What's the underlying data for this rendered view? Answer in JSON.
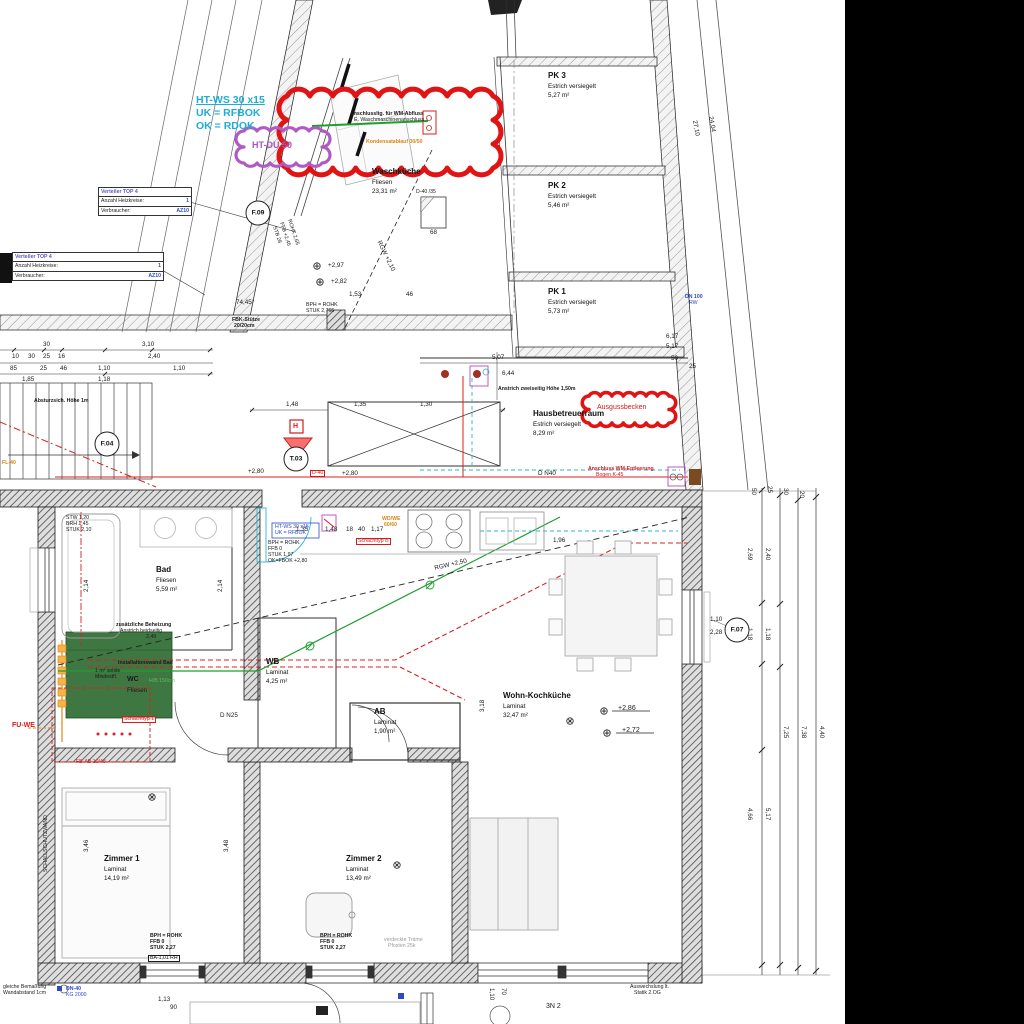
{
  "title": "Installationsplan Erdgeschoss (Ausschnitt)",
  "colors": {
    "annotation_red": "#e01414",
    "cloud_purple": "#b05ac4",
    "pipe_cyan": "#2ab5d8",
    "pipe_green": "#1f9e30",
    "pipe_red": "#d82020",
    "manifold_orange": "#e08a18",
    "label_blue": "#2d49c8",
    "wc_green": "#2f6b33",
    "background": "#ffffff",
    "void_right": "#000000"
  },
  "rooms": [
    {
      "name": "PK 3",
      "floor": "Estrich versiegelt",
      "area": "5,27 m²",
      "x": 548,
      "y": 70
    },
    {
      "name": "PK 2",
      "floor": "Estrich versiegelt",
      "area": "5,46 m²",
      "x": 548,
      "y": 180
    },
    {
      "name": "PK 1",
      "floor": "Estrich versiegelt",
      "area": "5,73 m²",
      "x": 548,
      "y": 286
    },
    {
      "name": "Waschküche",
      "floor": "Fliesen",
      "area": "23,31 m²",
      "x": 372,
      "y": 166
    },
    {
      "name": "Hausbetreuerraum",
      "floor": "Estrich versiegelt",
      "area": "8,29 m²",
      "x": 533,
      "y": 408
    },
    {
      "name": "Bad",
      "floor": "Fliesen",
      "area": "5,59 m²",
      "x": 156,
      "y": 564
    },
    {
      "name": "WB",
      "floor": "Laminat",
      "area": "4,25 m²",
      "x": 266,
      "y": 656
    },
    {
      "name": "AB",
      "floor": "Laminat",
      "area": "1,90 m²",
      "x": 374,
      "y": 706
    },
    {
      "name": "Wohn-Kochküche",
      "floor": "Laminat",
      "area": "32,47 m²",
      "x": 503,
      "y": 690
    },
    {
      "name": "Zimmer 1",
      "floor": "Laminat",
      "area": "14,19 m²",
      "x": 104,
      "y": 853
    },
    {
      "name": "Zimmer 2",
      "floor": "Laminat",
      "area": "13,49 m²",
      "x": 346,
      "y": 853
    }
  ],
  "tags": [
    {
      "t": "F.09",
      "x": 258,
      "y": 213
    },
    {
      "t": "F.04",
      "x": 107,
      "y": 444
    },
    {
      "t": "T.03",
      "x": 296,
      "y": 459
    },
    {
      "t": "F.07",
      "x": 737,
      "y": 630
    }
  ],
  "clouds": [
    {
      "name": "revision-cloud-wm",
      "x": 287,
      "y": 96,
      "w": 206,
      "h": 72,
      "r": 13,
      "color": "#e01414",
      "sw": 5
    },
    {
      "name": "revision-cloud-htdu",
      "x": 244,
      "y": 131,
      "w": 78,
      "h": 32,
      "r": 8,
      "color": "#b05ac4",
      "sw": 3.2
    },
    {
      "name": "revision-cloud-ausgussbecken",
      "x": 589,
      "y": 396,
      "w": 80,
      "h": 27,
      "r": 6.5,
      "color": "#e01414",
      "sw": 3.6
    }
  ],
  "symbols": [
    {
      "ch": "⊗",
      "x": 570,
      "y": 722,
      "n": "light-outlet-symbol"
    },
    {
      "ch": "⊗",
      "x": 397,
      "y": 866,
      "n": "light-outlet-symbol"
    },
    {
      "ch": "⊗",
      "x": 152,
      "y": 798,
      "n": "light-outlet-symbol"
    },
    {
      "ch": "⊕",
      "x": 604,
      "y": 712,
      "n": "level-point-symbol"
    },
    {
      "ch": "⊕",
      "x": 607,
      "y": 734,
      "n": "level-point-symbol"
    },
    {
      "ch": "⊕",
      "x": 317,
      "y": 267,
      "n": "level-point-symbol"
    },
    {
      "ch": "⊕",
      "x": 320,
      "y": 283,
      "n": "level-point-symbol"
    }
  ],
  "verteiler": {
    "title": "Verteiler TOP 4",
    "rows": [
      {
        "label": "Anzahl Heizkreise:",
        "value": "1"
      },
      {
        "label": "Verbraucher:",
        "value": "AZ10"
      }
    ]
  },
  "verteiler_boxes": [
    {
      "x": 98,
      "y": 187,
      "w": 92
    },
    {
      "x": 12,
      "y": 252,
      "w": 150
    }
  ],
  "labels": [
    {
      "t": "HT-WS 30 x15",
      "x": 196,
      "y": 95,
      "c": "cyan u"
    },
    {
      "t": "UK = RFBOK",
      "x": 196,
      "y": 108,
      "c": "cyan"
    },
    {
      "t": "OK = RDOK",
      "x": 196,
      "y": 121,
      "c": "cyan"
    },
    {
      "t": "HT-DU 50",
      "x": 252,
      "y": 141,
      "c": "purple"
    },
    {
      "t": "Anschlussltg. für WM-Abfluss",
      "x": 350,
      "y": 112,
      "c": "micro b"
    },
    {
      "t": "E. Waschmaschinenanschluss",
      "x": 354,
      "y": 118,
      "c": "micro"
    },
    {
      "t": "Kondensatablauf 30/50",
      "x": 366,
      "y": 140,
      "c": "micro orange b"
    },
    {
      "t": "D-40 /35",
      "x": 416,
      "y": 190,
      "c": "micro"
    },
    {
      "t": "68",
      "x": 430,
      "y": 230,
      "c": "d"
    },
    {
      "t": "74,45°",
      "x": 236,
      "y": 300,
      "c": "d"
    },
    {
      "t": "FFB +2,45",
      "x": 283,
      "y": 222,
      "c": "micro rot72"
    },
    {
      "t": "ROHK 2,65",
      "x": 291,
      "y": 219,
      "c": "micro rot72"
    },
    {
      "t": "STB 28",
      "x": 276,
      "y": 226,
      "c": "micro rot72"
    },
    {
      "t": "+2,97",
      "x": 328,
      "y": 263,
      "c": "d"
    },
    {
      "t": "+2,82",
      "x": 331,
      "y": 279,
      "c": "d"
    },
    {
      "t": "1,53",
      "x": 349,
      "y": 292,
      "c": "d"
    },
    {
      "t": "46",
      "x": 406,
      "y": 292,
      "c": "d"
    },
    {
      "t": "BPH = ROHK",
      "x": 306,
      "y": 303,
      "c": "micro"
    },
    {
      "t": "STUK 2,765",
      "x": 306,
      "y": 309,
      "c": "micro"
    },
    {
      "t": "RGW +2,10",
      "x": 381,
      "y": 240,
      "c": "d rot64"
    },
    {
      "t": "27,10",
      "x": 697,
      "y": 120,
      "c": "d rot80"
    },
    {
      "t": "24,04",
      "x": 713,
      "y": 116,
      "c": "d rot80"
    },
    {
      "t": "DN 100",
      "x": 685,
      "y": 295,
      "c": "micro blue b"
    },
    {
      "t": "RW",
      "x": 689,
      "y": 301,
      "c": "micro blue"
    },
    {
      "t": "FBK-Stütze",
      "x": 232,
      "y": 318,
      "c": "micro b"
    },
    {
      "t": "20/20cm",
      "x": 234,
      "y": 324,
      "c": "micro b"
    },
    {
      "t": "6,17",
      "x": 666,
      "y": 334,
      "c": "d"
    },
    {
      "t": "5,17",
      "x": 666,
      "y": 344,
      "c": "d"
    },
    {
      "t": "30",
      "x": 43,
      "y": 342,
      "c": "d"
    },
    {
      "t": "3,10",
      "x": 142,
      "y": 342,
      "c": "d"
    },
    {
      "t": "10",
      "x": 12,
      "y": 354,
      "c": "d"
    },
    {
      "t": "30",
      "x": 28,
      "y": 354,
      "c": "d"
    },
    {
      "t": "25",
      "x": 43,
      "y": 354,
      "c": "d"
    },
    {
      "t": "16",
      "x": 58,
      "y": 354,
      "c": "d"
    },
    {
      "t": "2,40",
      "x": 148,
      "y": 354,
      "c": "d"
    },
    {
      "t": "85",
      "x": 10,
      "y": 366,
      "c": "d"
    },
    {
      "t": "25",
      "x": 40,
      "y": 366,
      "c": "d"
    },
    {
      "t": "46",
      "x": 60,
      "y": 366,
      "c": "d"
    },
    {
      "t": "1,10",
      "x": 98,
      "y": 366,
      "c": "d"
    },
    {
      "t": "1,10",
      "x": 173,
      "y": 366,
      "c": "d"
    },
    {
      "t": "1,85",
      "x": 22,
      "y": 377,
      "c": "d"
    },
    {
      "t": "1,18",
      "x": 98,
      "y": 377,
      "c": "d"
    },
    {
      "t": "Absturzsich. Höhe 1m",
      "x": 34,
      "y": 399,
      "c": "micro b"
    },
    {
      "t": "FL-40",
      "x": 2,
      "y": 461,
      "c": "micro orange b"
    },
    {
      "t": "1,48",
      "x": 286,
      "y": 402,
      "c": "d"
    },
    {
      "t": "1,35",
      "x": 354,
      "y": 402,
      "c": "d"
    },
    {
      "t": "1,30",
      "x": 420,
      "y": 402,
      "c": "d"
    },
    {
      "t": "H",
      "x": 293,
      "y": 423,
      "c": "s red b"
    },
    {
      "t": "+2,80",
      "x": 248,
      "y": 469,
      "c": "d"
    },
    {
      "t": "+2,80",
      "x": 342,
      "y": 471,
      "c": "d"
    },
    {
      "t": "D-40",
      "x": 310,
      "y": 470,
      "c": "micro red boxed"
    },
    {
      "t": "5,07",
      "x": 492,
      "y": 355,
      "c": "d"
    },
    {
      "t": "6,44",
      "x": 502,
      "y": 371,
      "c": "d"
    },
    {
      "t": "50",
      "x": 671,
      "y": 356,
      "c": "d"
    },
    {
      "t": "25",
      "x": 689,
      "y": 364,
      "c": "d"
    },
    {
      "t": "Anstrich zweiseitig Höhe 1,50m",
      "x": 498,
      "y": 387,
      "c": "micro b"
    },
    {
      "t": "Ausgussbecken",
      "x": 597,
      "y": 404,
      "c": "s red"
    },
    {
      "t": "D N40",
      "x": 538,
      "y": 471,
      "c": "d"
    },
    {
      "t": "Anschluss WM-Entleerung",
      "x": 588,
      "y": 467,
      "c": "micro red b"
    },
    {
      "t": "Bogen K-45",
      "x": 596,
      "y": 473,
      "c": "micro red"
    },
    {
      "t": "STW 1,20",
      "x": 66,
      "y": 516,
      "c": "micro"
    },
    {
      "t": "BRH 1,45",
      "x": 66,
      "y": 522,
      "c": "micro"
    },
    {
      "t": "STUK 2,10",
      "x": 66,
      "y": 528,
      "c": "micro"
    },
    {
      "t": "1,35",
      "x": 296,
      "y": 527,
      "c": "d"
    },
    {
      "t": "1,48",
      "x": 325,
      "y": 527,
      "c": "d"
    },
    {
      "t": "18",
      "x": 346,
      "y": 527,
      "c": "d"
    },
    {
      "t": "40",
      "x": 358,
      "y": 527,
      "c": "d"
    },
    {
      "t": "1,17",
      "x": 371,
      "y": 527,
      "c": "d"
    },
    {
      "t": "1,96",
      "x": 553,
      "y": 538,
      "c": "d"
    },
    {
      "t": "WD/WE",
      "x": 382,
      "y": 517,
      "c": "micro orange b"
    },
    {
      "t": "60/60",
      "x": 384,
      "y": 523,
      "c": "micro orange b"
    },
    {
      "t": "Schachttyp B",
      "x": 356,
      "y": 538,
      "c": "micro red boxed"
    },
    {
      "t": "HT-WS 30 x15",
      "x": 275,
      "y": 525,
      "c": "micro blue"
    },
    {
      "t": "UK = RFBOK",
      "x": 275,
      "y": 531,
      "c": "micro blue"
    },
    {
      "t": "BPH = ROHK",
      "x": 268,
      "y": 541,
      "c": "micro"
    },
    {
      "t": "FFB 0",
      "x": 268,
      "y": 547,
      "c": "micro"
    },
    {
      "t": "STUK 1,97",
      "x": 268,
      "y": 553,
      "c": "micro"
    },
    {
      "t": "OK=FBOK +2,80",
      "x": 268,
      "y": 559,
      "c": "micro"
    },
    {
      "t": "2,14",
      "x": 84,
      "y": 592,
      "c": "d rotm90"
    },
    {
      "t": "2,14",
      "x": 218,
      "y": 592,
      "c": "d rotm90"
    },
    {
      "t": "zusätzliche Beheizung",
      "x": 116,
      "y": 623,
      "c": "micro b"
    },
    {
      "t": "Anstrich beidseitig",
      "x": 120,
      "y": 629,
      "c": "micro"
    },
    {
      "t": "2,49",
      "x": 146,
      "y": 635,
      "c": "micro"
    },
    {
      "t": "Installationswand Bad",
      "x": 118,
      "y": 661,
      "c": "micro b"
    },
    {
      "t": "1 m² solide",
      "x": 95,
      "y": 669,
      "c": "micro"
    },
    {
      "t": "Mindestfl.",
      "x": 95,
      "y": 675,
      "c": "micro"
    },
    {
      "t": "WC",
      "x": 127,
      "y": 676,
      "c": "b"
    },
    {
      "t": "Fliesen",
      "x": 127,
      "y": 688,
      "c": "d"
    },
    {
      "t": "H/B 150cm",
      "x": 149,
      "y": 679,
      "c": "micro green2"
    },
    {
      "t": "D N25",
      "x": 220,
      "y": 713,
      "c": "d"
    },
    {
      "t": "Schachttyp 1",
      "x": 122,
      "y": 716,
      "c": "micro red boxed"
    },
    {
      "t": "FU-WE",
      "x": 12,
      "y": 722,
      "c": "s red b"
    },
    {
      "t": "FB-AB 10/48",
      "x": 76,
      "y": 760,
      "c": "micro red"
    },
    {
      "t": "+2,86",
      "x": 618,
      "y": 705,
      "c": "s"
    },
    {
      "t": "+2,72",
      "x": 622,
      "y": 727,
      "c": "s"
    },
    {
      "t": "1,10",
      "x": 710,
      "y": 617,
      "c": "d"
    },
    {
      "t": "2,28",
      "x": 710,
      "y": 630,
      "c": "d"
    },
    {
      "t": "SCHALLSCHUTZWAND",
      "x": 44,
      "y": 872,
      "c": "micro rotm90"
    },
    {
      "t": "3,46",
      "x": 84,
      "y": 852,
      "c": "d rotm90"
    },
    {
      "t": "3,48",
      "x": 224,
      "y": 852,
      "c": "d rotm90"
    },
    {
      "t": "3,18",
      "x": 480,
      "y": 712,
      "c": "d rotm90"
    },
    {
      "t": "BPH = ROHK",
      "x": 150,
      "y": 934,
      "c": "micro b"
    },
    {
      "t": "FFB 0",
      "x": 150,
      "y": 940,
      "c": "micro b"
    },
    {
      "t": "STUK 2,27",
      "x": 150,
      "y": 946,
      "c": "micro b"
    },
    {
      "t": "BPH = ROHK",
      "x": 320,
      "y": 934,
      "c": "micro b"
    },
    {
      "t": "FFB 0",
      "x": 320,
      "y": 940,
      "c": "micro b"
    },
    {
      "t": "STUK 2,27",
      "x": 320,
      "y": 946,
      "c": "micro b"
    },
    {
      "t": "verdeckte Träme",
      "x": 384,
      "y": 938,
      "c": "micro gray"
    },
    {
      "t": "Pfosten 25k",
      "x": 388,
      "y": 944,
      "c": "micro gray"
    },
    {
      "t": "BA-1,01 RH",
      "x": 148,
      "y": 955,
      "c": "micro boxed"
    },
    {
      "t": "RGW +2,50",
      "x": 434,
      "y": 566,
      "c": "d rotm13"
    },
    {
      "t": "2,69",
      "x": 752,
      "y": 548,
      "c": "d rot90"
    },
    {
      "t": "2,40",
      "x": 770,
      "y": 548,
      "c": "d rot90"
    },
    {
      "t": "1,18",
      "x": 752,
      "y": 628,
      "c": "d rot90"
    },
    {
      "t": "1,18",
      "x": 770,
      "y": 628,
      "c": "d rot90"
    },
    {
      "t": "4,66",
      "x": 752,
      "y": 808,
      "c": "d rot90"
    },
    {
      "t": "5,17",
      "x": 770,
      "y": 808,
      "c": "d rot90"
    },
    {
      "t": "7,25",
      "x": 788,
      "y": 726,
      "c": "d rot90"
    },
    {
      "t": "7,38",
      "x": 806,
      "y": 726,
      "c": "d rot90"
    },
    {
      "t": "4,40",
      "x": 824,
      "y": 726,
      "c": "d rot90"
    },
    {
      "t": "50",
      "x": 756,
      "y": 488,
      "c": "d rot90"
    },
    {
      "t": "25",
      "x": 772,
      "y": 486,
      "c": "d rot90"
    },
    {
      "t": "30",
      "x": 788,
      "y": 488,
      "c": "d rot90"
    },
    {
      "t": "20",
      "x": 804,
      "y": 491,
      "c": "d rot90"
    },
    {
      "t": "gleiche Bemaßung",
      "x": 3,
      "y": 985,
      "c": "micro"
    },
    {
      "t": "Wandabstand 1cm",
      "x": 3,
      "y": 991,
      "c": "micro"
    },
    {
      "t": "DN-40",
      "x": 66,
      "y": 987,
      "c": "micro blue b"
    },
    {
      "t": "KG 2000",
      "x": 66,
      "y": 993,
      "c": "micro blue"
    },
    {
      "t": "1,13",
      "x": 158,
      "y": 997,
      "c": "d"
    },
    {
      "t": "90",
      "x": 170,
      "y": 1005,
      "c": "d"
    },
    {
      "t": "1,10",
      "x": 494,
      "y": 988,
      "c": "d rot90"
    },
    {
      "t": "70",
      "x": 506,
      "y": 988,
      "c": "d rot90"
    },
    {
      "t": "Auswechslung lt.",
      "x": 630,
      "y": 985,
      "c": "micro"
    },
    {
      "t": "Statik 2.OG",
      "x": 634,
      "y": 991,
      "c": "micro"
    },
    {
      "t": "3N 2",
      "x": 546,
      "y": 1003,
      "c": "s"
    }
  ]
}
